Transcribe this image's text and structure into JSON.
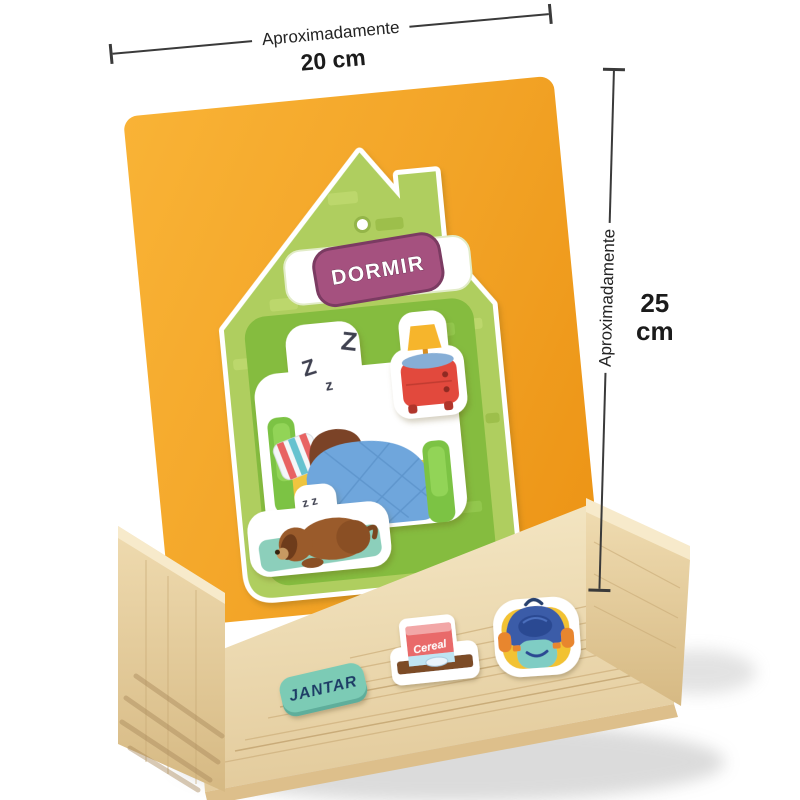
{
  "annotations": {
    "width": {
      "label": "Aproximadamente",
      "value": "20 cm"
    },
    "height": {
      "label": "Aproximadamente",
      "value": "25",
      "unit": "cm"
    }
  },
  "easel_card": {
    "shape": "house",
    "activity_label": "DORMIR",
    "sleep_z_big": "Z",
    "sleep_z_mid": "Z",
    "sleep_z_small": "z",
    "dog_z": "z z",
    "stickers": [
      "sleeping-boy-in-bed",
      "nightstand-lamp",
      "sleeping-dog"
    ]
  },
  "tray": {
    "meal_label": "JANTAR",
    "cereal_box_text": "Cereal",
    "magnets": [
      "jantar-label-magnet",
      "cereal-box-magnet",
      "backpack-magnet"
    ]
  },
  "palette": {
    "board_orange": "#F2A326",
    "house_green": "#AFCE5F",
    "panel_green": "#85BC3F",
    "badge_purple": "#A5517F",
    "badge_mint": "#7CCBB5",
    "wood_light": "#F5E8C6",
    "wood_mid": "#DFC59A",
    "dimension_line": "#3A3A3A"
  }
}
